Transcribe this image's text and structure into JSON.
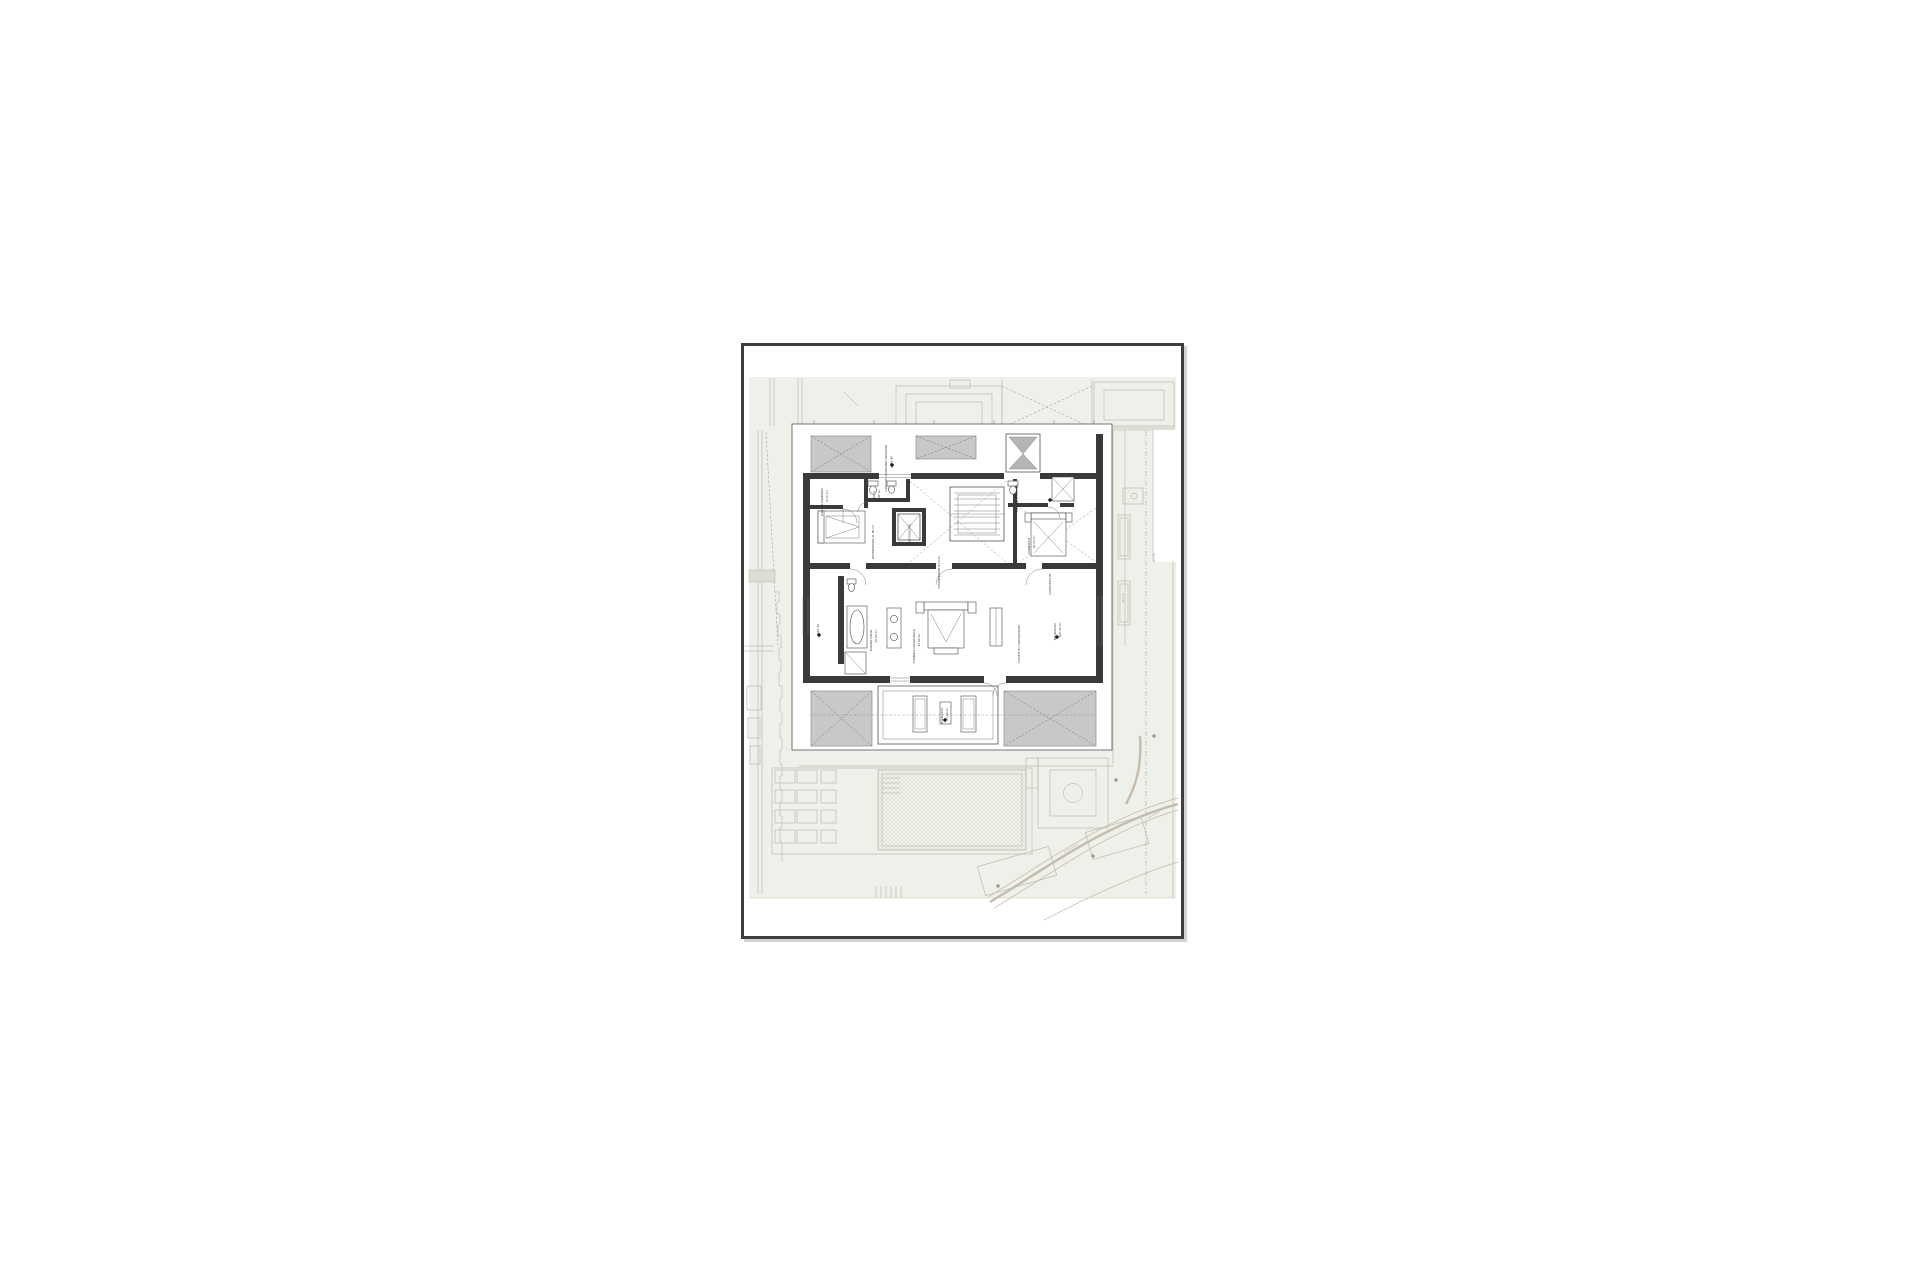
{
  "document": {
    "type_label": "architectural floor plan sheet",
    "colors": {
      "sheet_border": "#3e3e3e",
      "ink": "#3a3a3a",
      "wall_fill": "#3a3a3a",
      "roof_hatch_fill": "#c8c8c8",
      "ground_tint": "#eef0e9",
      "site_line": "#b8bcb1",
      "road": "#c6bcab",
      "paper": "#ffffff"
    }
  },
  "plan": {
    "labels": [
      {
        "text": "COPERT. GIARDINO INVERNO",
        "x": 143,
        "y": 122,
        "rot": true
      },
      {
        "text": "+315.90",
        "x": 148.5,
        "y": 116,
        "rot": true
      },
      {
        "text": "CABINA ARMADIO",
        "x": 79,
        "y": 156,
        "rot": true
      },
      {
        "text": "9.10 m²",
        "x": 84,
        "y": 150,
        "rot": true
      },
      {
        "text": "WC 1",
        "x": 131,
        "y": 149,
        "rot": true
      },
      {
        "text": "2.90 m²",
        "x": 136,
        "y": 149,
        "rot": true
      },
      {
        "text": "DISIMPEGNO 11.80 m²",
        "x": 130,
        "y": 196,
        "rot": true
      },
      {
        "text": "ASCENSORE",
        "x": 166.5,
        "y": 188,
        "rot": true
      },
      {
        "text": "BAGNO B 4.20 m²",
        "x": 274,
        "y": 152,
        "rot": true
      },
      {
        "text": "CAMERA B",
        "x": 286,
        "y": 200,
        "rot": true
      },
      {
        "text": "16.10 m²",
        "x": 291,
        "y": 196,
        "rot": true
      },
      {
        "text": "DISIMPEGNO 5.10 m²",
        "x": 196,
        "y": 226,
        "rot": true
      },
      {
        "text": "RIPOSTIGLIO",
        "x": 307,
        "y": 238,
        "rot": true
      },
      {
        "text": "BAGNO PADR.",
        "x": 128,
        "y": 294,
        "rot": true
      },
      {
        "text": "12.60 m²",
        "x": 133,
        "y": 290,
        "rot": true
      },
      {
        "text": "CAMERA PADRONALE",
        "x": 171,
        "y": 300,
        "rot": true
      },
      {
        "text": "31.60 m²",
        "x": 176,
        "y": 294,
        "rot": true
      },
      {
        "text": "VUOTO SU SOGGIORNO",
        "x": 276,
        "y": 298,
        "rot": true
      },
      {
        "text": "TERRAZZO",
        "x": 312,
        "y": 286,
        "rot": true
      },
      {
        "text": "102.40 m²",
        "x": 317,
        "y": 284,
        "rot": true
      },
      {
        "text": "+312.40",
        "x": 75,
        "y": 284,
        "rot": true
      },
      {
        "text": "TERRAZZA",
        "x": 199,
        "y": 370,
        "rot": true
      },
      {
        "text": "21.60 m²",
        "x": 204,
        "y": 368,
        "rot": true
      },
      {
        "text": "316.40",
        "x": 411,
        "y": 212,
        "rot": true,
        "cls": "lite"
      },
      {
        "text": "315.20",
        "x": 380,
        "y": 252,
        "rot": true,
        "cls": "lite"
      }
    ],
    "elevation_markers": [
      {
        "x": 148,
        "y": 119
      },
      {
        "x": 75,
        "y": 289
      },
      {
        "x": 201,
        "y": 374
      },
      {
        "x": 306,
        "y": 154
      },
      {
        "x": 313,
        "y": 291
      },
      {
        "x": 410,
        "y": 390,
        "cls": "lite"
      },
      {
        "x": 372,
        "y": 434,
        "cls": "lite"
      },
      {
        "x": 349,
        "y": 510,
        "cls": "lite"
      },
      {
        "x": 254,
        "y": 540,
        "cls": "lite"
      }
    ]
  }
}
